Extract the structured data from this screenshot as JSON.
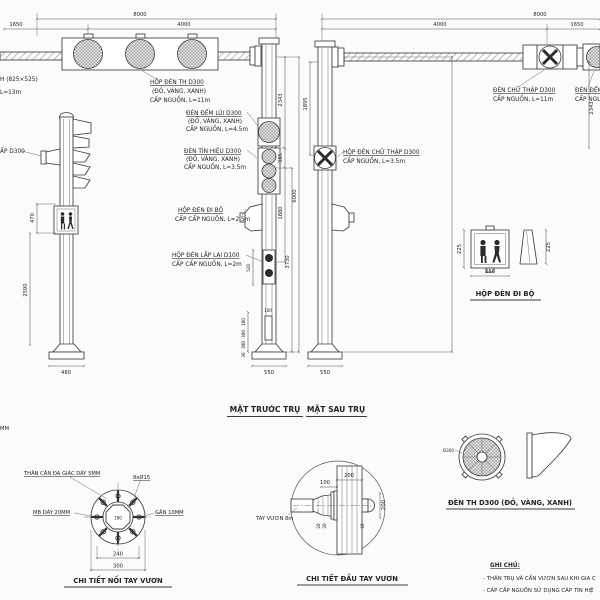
{
  "colors": {
    "background": "#fbfbf9",
    "line": "#3c3c3c",
    "dark_fill": "#2b2b2b",
    "text": "#242424"
  },
  "captions": {
    "front_view": "MẶT TRƯỚC TRỤ",
    "back_view": "MẶT SAU TRỤ",
    "ped_box_detail": "HỘP ĐÈN ĐI BỘ",
    "flange_detail": "CHI TIẾT NỐI TAY VƯƠN",
    "arm_end_detail": "CHI TIẾT ĐẦU TAY VƯƠN",
    "lamp_detail": "ĐÈN TH D300 (ĐỎ, VÀNG, XANH)"
  },
  "labels": {
    "th_big_cut_1": "H (825×525)",
    "th_big_cut_2": "L=13m",
    "th_d300_1": "HỘP ĐÈN TH D300",
    "th_d300_2": "(ĐỎ, VÀNG, XANH)",
    "th_d300_3": "CẤP NGUỒN, L=11m",
    "dem_lui_1": "ĐÈN ĐẾM LÙI D300",
    "dem_lui_2": "(ĐỎ, VÀNG, XANH)",
    "dem_lui_3": "CẤP NGUỒN, L=4.5m",
    "tin_hieu_1": "ĐÈN TÍN HIỆU D300",
    "tin_hieu_2": "(ĐỎ, VÀNG, XANH)",
    "tin_hieu_3": "CẤP NGUỒN, L=3.5m",
    "di_bo_1": "HỘP ĐÈN ĐI BỘ",
    "di_bo_2": "CẤP CẤP NGUỒN, L=2.5m",
    "lap_lai_1": "HỘP ĐÈN LẮP LẠI D100",
    "lap_lai_2": "CẤP CẤP NGUỒN, L=2m",
    "chu_thap_cut": "ẤP D300",
    "hop_chu_thap_1": "HỘP ĐÈN CHỮ THẬP D300",
    "hop_chu_thap_2": "CẤP NGUỒN, L=3.5m",
    "den_chu_thap_1": "ĐÈN CHỮ THẬP D300",
    "den_chu_thap_2": "CẤP NGUỒN, L=11m",
    "dem_right_cut_1": "ĐÈN ĐẾM",
    "dem_right_cut_2": "CẤP NGUỒ",
    "tay_vuon": "TAY VƯƠN 8m",
    "than_can": "THÂN CẦN ĐA GIÁC DÀY 5MM",
    "bolts": "8xØ15",
    "mb": "MB DÀY 20MM",
    "gan": "GÂN 10MM",
    "d300": "D300",
    "mm_cut": "MM"
  },
  "dims": {
    "top_overall": "8000",
    "top_seg_a": "1650",
    "top_seg_b": "4000",
    "h_2343": "2343",
    "h_1895": "1895",
    "h_385": "385",
    "h_1880": "1880",
    "h_6000": "6000",
    "h_3730": "3730",
    "h_520": "520",
    "h_470": "470",
    "h_2590": "2590",
    "base_480": "480",
    "base_550": "550",
    "door_100": "100",
    "door_300": "300",
    "door_30": "30",
    "ped_225": "225",
    "ped_250": "250",
    "flange_180": "180",
    "flange_240": "240",
    "flange_300": "300",
    "arm_200": "200",
    "arm_100": "100",
    "arm_20": "20"
  },
  "notes": {
    "title": "GHI CHÚ:",
    "line1": "- THÂN TRỤ VÀ CẦN VƯƠN SAU KHI GIA C",
    "line2": "- CÁP CẤP NGUỒN SỬ DỤNG CÁP TÍN HIỆ"
  }
}
